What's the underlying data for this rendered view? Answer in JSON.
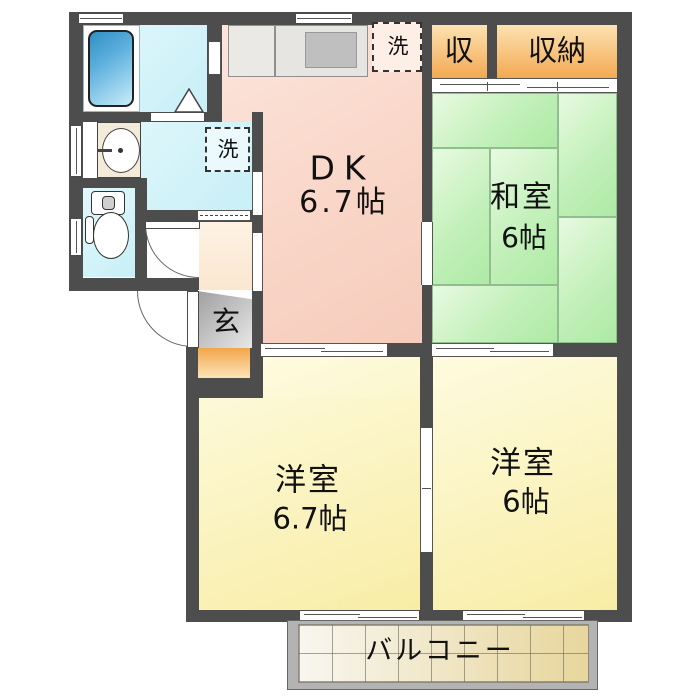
{
  "title": "2DK apartment floor plan",
  "rooms": {
    "dk": {
      "label": "DK",
      "size": "6.7帖"
    },
    "washitsu": {
      "label": "和室",
      "size": "6帖"
    },
    "western_left": {
      "label": "洋室",
      "size": "6.7帖"
    },
    "western_right": {
      "label": "洋室",
      "size": "6帖"
    },
    "balcony": {
      "label": "バルコニー"
    },
    "entrance": {
      "label": "玄"
    },
    "closet_small": {
      "label": "収"
    },
    "closet_big": {
      "label": "収納"
    },
    "laundry": {
      "label": "洗"
    }
  },
  "colors": {
    "wall": "#4d4d4d",
    "dk_floor": "#f9d6c8",
    "tatami_green": "#c3f0ba",
    "western_yellow": "#faf0b0",
    "water_cyan": "#d2f3f9",
    "closet_orange": "#f5b160",
    "entrance_gray": "#b5b5b5",
    "step_orange": "#f2a64b",
    "balcony_tile": "#e8d69c",
    "bathtub_blue": "#4aa3d6"
  }
}
